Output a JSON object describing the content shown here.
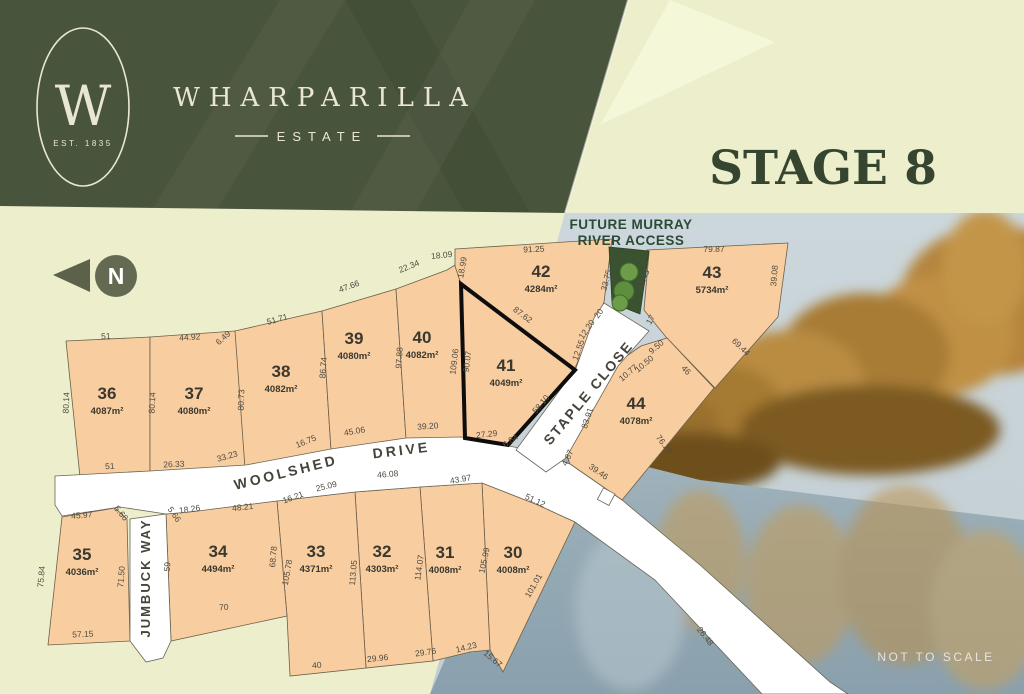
{
  "branding": {
    "monogram": "W",
    "established": "EST. 1835",
    "name": "WHARPARILLA",
    "type": "ESTATE"
  },
  "stage_title": "STAGE 8",
  "banner": {
    "line1": "FUTURE MURRAY",
    "line2": "RIVER ACCESS"
  },
  "north_label": "N",
  "scale_note": "NOT TO SCALE",
  "colors": {
    "header_green": "#49543c",
    "cream": "#e9e7d4",
    "pale_bg": "#edeecb",
    "accent_wedge": "#f6f8d8",
    "stage_text": "#36452f",
    "lot_fill": "#f8cda0",
    "lot_stroke": "#6b5f4a",
    "bold_lot_stroke": "#0d0d0d",
    "road_fill": "#ffffff",
    "road_stroke": "#6a6455",
    "reserve_green": "#3a5230",
    "tree_green": "#6f9c49",
    "banner_text": "#2b4a35",
    "dim_text": "#4f4b40",
    "lot_text": "#3a382f"
  },
  "streets": [
    {
      "name": "WOOLSHED",
      "x": 287,
      "y": 477,
      "rot": -14,
      "fs": 14,
      "ls": 3
    },
    {
      "name": "DRIVE",
      "x": 402,
      "y": 455,
      "rot": -7,
      "fs": 14,
      "ls": 3
    },
    {
      "name": "JUMBUCK WAY",
      "x": 150,
      "y": 578,
      "rot": -90,
      "fs": 13,
      "ls": 2
    },
    {
      "name": "STAPLE CLOSE",
      "x": 592,
      "y": 396,
      "rot": -50,
      "fs": 14,
      "ls": 2
    }
  ],
  "lots": [
    {
      "num": "30",
      "area": "4008m²",
      "points": "482,483 538,505 575,522 503,672 490,650",
      "lx": 513,
      "ly": 558,
      "bold": false
    },
    {
      "num": "31",
      "area": "4008m²",
      "points": "420,487 482,483 490,650 470,652 433,661",
      "lx": 445,
      "ly": 558,
      "bold": false
    },
    {
      "num": "32",
      "area": "4303m²",
      "points": "355,492 420,487 433,661 366,668",
      "lx": 382,
      "ly": 557,
      "bold": false
    },
    {
      "num": "33",
      "area": "4371m²",
      "points": "277,501 355,492 366,668 290,676 287,616",
      "lx": 316,
      "ly": 557,
      "bold": false
    },
    {
      "num": "34",
      "area": "4494m²",
      "points": "166,514 277,501 287,616 171,641",
      "lx": 218,
      "ly": 557,
      "bold": false
    },
    {
      "num": "35",
      "area": "4036m²",
      "points": "62,517 115,508 127,519 130,641 48,645",
      "lx": 82,
      "ly": 560,
      "bold": false
    },
    {
      "num": "36",
      "area": "4087m²",
      "points": "66,341 150,337 150,472 80,477",
      "lx": 107,
      "ly": 399,
      "bold": false
    },
    {
      "num": "37",
      "area": "4080m²",
      "points": "150,337 235,331 240,336 245,468 150,472",
      "lx": 194,
      "ly": 399,
      "bold": false
    },
    {
      "num": "38",
      "area": "4082m²",
      "points": "235,331 322,311 331,450 245,468",
      "lx": 281,
      "ly": 377,
      "bold": false
    },
    {
      "num": "39",
      "area": "4080m²",
      "points": "322,311 396,289 406,439 331,450",
      "lx": 354,
      "ly": 344,
      "bold": false
    },
    {
      "num": "40",
      "area": "4082m²",
      "points": "396,289 447,270 455,265 461,284 465,438 406,439",
      "lx": 422,
      "ly": 343,
      "bold": false
    },
    {
      "num": "41",
      "area": "4049m²",
      "points": "461,284 575,370 508,445 465,438",
      "lx": 506,
      "ly": 371,
      "bold": true
    },
    {
      "num": "42",
      "area": "4284m²",
      "points": "455,249 612,239 604,302 575,368 461,284 455,266",
      "lx": 541,
      "ly": 277,
      "bold": false
    },
    {
      "num": "43",
      "area": "5734m²",
      "points": "647,250 788,243 778,317 715,388 666,337 644,310 649,252",
      "lx": 712,
      "ly": 278,
      "bold": false
    },
    {
      "num": "44",
      "area": "4078m²",
      "points": "618,362 641,346 667,338 714,388 622,500 570,464 566,454",
      "lx": 636,
      "ly": 409,
      "bold": false
    }
  ],
  "dims": [
    {
      "t": "51",
      "x": 106,
      "y": 339,
      "r": -3
    },
    {
      "t": "80.14",
      "x": 69,
      "y": 403,
      "r": -87
    },
    {
      "t": "80.14",
      "x": 155,
      "y": 403,
      "r": -87
    },
    {
      "t": "44.92",
      "x": 190,
      "y": 340,
      "r": -4
    },
    {
      "t": "6.49",
      "x": 225,
      "y": 340,
      "r": -42
    },
    {
      "t": "80.73",
      "x": 244,
      "y": 400,
      "r": -88
    },
    {
      "t": "51.71",
      "x": 278,
      "y": 322,
      "r": -16
    },
    {
      "t": "86.74",
      "x": 326,
      "y": 368,
      "r": -85
    },
    {
      "t": "47.66",
      "x": 350,
      "y": 289,
      "r": -20
    },
    {
      "t": "97.88",
      "x": 402,
      "y": 358,
      "r": -86
    },
    {
      "t": "22.34",
      "x": 410,
      "y": 269,
      "r": -22
    },
    {
      "t": "18.09",
      "x": 442,
      "y": 258,
      "r": -6
    },
    {
      "t": "109.06",
      "x": 457,
      "y": 362,
      "r": -83
    },
    {
      "t": "90.07",
      "x": 470,
      "y": 362,
      "r": -83
    },
    {
      "t": "18.99",
      "x": 465,
      "y": 268,
      "r": -80
    },
    {
      "t": "91.25",
      "x": 534,
      "y": 252,
      "r": -3
    },
    {
      "t": "87.62",
      "x": 521,
      "y": 317,
      "r": 37
    },
    {
      "t": "33.75",
      "x": 609,
      "y": 281,
      "r": -75
    },
    {
      "t": "43.43",
      "x": 646,
      "y": 281,
      "r": -70
    },
    {
      "t": "79.87",
      "x": 714,
      "y": 252,
      "r": 0
    },
    {
      "t": "39.08",
      "x": 777,
      "y": 276,
      "r": -85
    },
    {
      "t": "69.44",
      "x": 739,
      "y": 349,
      "r": 44
    },
    {
      "t": "17",
      "x": 653,
      "y": 321,
      "r": -60
    },
    {
      "t": "20",
      "x": 601,
      "y": 315,
      "r": -55
    },
    {
      "t": "12.20",
      "x": 589,
      "y": 331,
      "r": -55
    },
    {
      "t": "12.55",
      "x": 581,
      "y": 351,
      "r": -70
    },
    {
      "t": "9.50",
      "x": 658,
      "y": 349,
      "r": -40
    },
    {
      "t": "10.50",
      "x": 646,
      "y": 366,
      "r": -40
    },
    {
      "t": "10.77",
      "x": 630,
      "y": 375,
      "r": -40
    },
    {
      "t": "46",
      "x": 684,
      "y": 372,
      "r": 48
    },
    {
      "t": "83.91",
      "x": 590,
      "y": 419,
      "r": -72
    },
    {
      "t": "58.10",
      "x": 543,
      "y": 406,
      "r": -50
    },
    {
      "t": "27.29",
      "x": 487,
      "y": 437,
      "r": -6
    },
    {
      "t": "6.84",
      "x": 512,
      "y": 443,
      "r": -35
    },
    {
      "t": "4.87",
      "x": 570,
      "y": 459,
      "r": -65
    },
    {
      "t": "39.46",
      "x": 597,
      "y": 474,
      "r": 35
    },
    {
      "t": "76.29",
      "x": 662,
      "y": 446,
      "r": 52
    },
    {
      "t": "51",
      "x": 110,
      "y": 469,
      "r": -3
    },
    {
      "t": "26.33",
      "x": 174,
      "y": 467,
      "r": -3
    },
    {
      "t": "33.23",
      "x": 228,
      "y": 459,
      "r": -16
    },
    {
      "t": "16.75",
      "x": 307,
      "y": 444,
      "r": -22
    },
    {
      "t": "45.06",
      "x": 355,
      "y": 434,
      "r": -10
    },
    {
      "t": "39.20",
      "x": 428,
      "y": 429,
      "r": -4
    },
    {
      "t": "43.97",
      "x": 461,
      "y": 482,
      "r": -10
    },
    {
      "t": "51.12",
      "x": 534,
      "y": 503,
      "r": 25
    },
    {
      "t": "45.97",
      "x": 82,
      "y": 518,
      "r": -5
    },
    {
      "t": "5.66",
      "x": 119,
      "y": 515,
      "r": 50
    },
    {
      "t": "5.66",
      "x": 172,
      "y": 516,
      "r": 55
    },
    {
      "t": "18.26",
      "x": 190,
      "y": 512,
      "r": -8
    },
    {
      "t": "48.21",
      "x": 243,
      "y": 510,
      "r": -6
    },
    {
      "t": "16.21",
      "x": 294,
      "y": 500,
      "r": -20
    },
    {
      "t": "25.09",
      "x": 327,
      "y": 489,
      "r": -14
    },
    {
      "t": "46.08",
      "x": 388,
      "y": 477,
      "r": -5
    },
    {
      "t": "75.84",
      "x": 44,
      "y": 577,
      "r": -85
    },
    {
      "t": "71.50",
      "x": 124,
      "y": 577,
      "r": -85
    },
    {
      "t": "57.15",
      "x": 83,
      "y": 637,
      "r": -3
    },
    {
      "t": "59",
      "x": 170,
      "y": 567,
      "r": -85
    },
    {
      "t": "68.78",
      "x": 276,
      "y": 557,
      "r": -85
    },
    {
      "t": "105.78",
      "x": 290,
      "y": 573,
      "r": -80
    },
    {
      "t": "113.05",
      "x": 356,
      "y": 573,
      "r": -85
    },
    {
      "t": "114.07",
      "x": 422,
      "y": 568,
      "r": -82
    },
    {
      "t": "105.99",
      "x": 487,
      "y": 561,
      "r": -78
    },
    {
      "t": "101.01",
      "x": 536,
      "y": 587,
      "r": -60
    },
    {
      "t": "70",
      "x": 224,
      "y": 610,
      "r": -4
    },
    {
      "t": "40",
      "x": 317,
      "y": 668,
      "r": -4
    },
    {
      "t": "29.96",
      "x": 378,
      "y": 661,
      "r": -6
    },
    {
      "t": "29.76",
      "x": 426,
      "y": 655,
      "r": -8
    },
    {
      "t": "14.23",
      "x": 467,
      "y": 650,
      "r": -14
    },
    {
      "t": "15.67",
      "x": 491,
      "y": 661,
      "r": 40
    },
    {
      "t": "26.48",
      "x": 703,
      "y": 638,
      "r": 52
    }
  ],
  "trees": [
    {
      "x": 629,
      "y": 272,
      "r": 9
    },
    {
      "x": 624,
      "y": 291,
      "r": 10
    },
    {
      "x": 620,
      "y": 303,
      "r": 8
    }
  ]
}
